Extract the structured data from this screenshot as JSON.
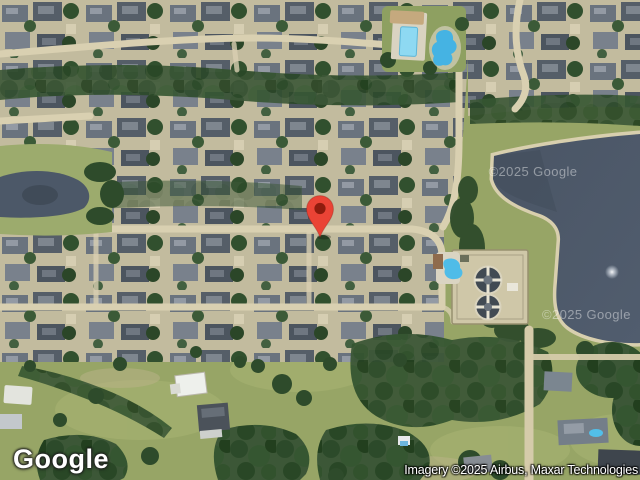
{
  "map": {
    "view_type": "satellite",
    "logo_text": "Google",
    "attribution_text": "Imagery ©2025 Airbus, Maxar Technologies",
    "watermarks": [
      {
        "text": "©2025 Google"
      },
      {
        "text": "©2025 Google"
      }
    ],
    "marker": {
      "label": "Dropped pin",
      "x": 320,
      "y": 237
    },
    "features": [
      "residential-neighborhood",
      "lake-with-fountain",
      "pond",
      "community-pool",
      "water-treatment-tanks",
      "open-field",
      "dirt-road"
    ]
  },
  "colors": {
    "marker-red": "#EA4335",
    "marker-inner-red": "#8E1B0D",
    "water": "#4C5868",
    "road-tan": "#D9D0B1",
    "grass-green": "#97A566",
    "tree-green": "#33502F",
    "roof-gray": "#5C656F",
    "pool-blue": "#45B3E3",
    "logo-white": "#FFFFFF"
  }
}
